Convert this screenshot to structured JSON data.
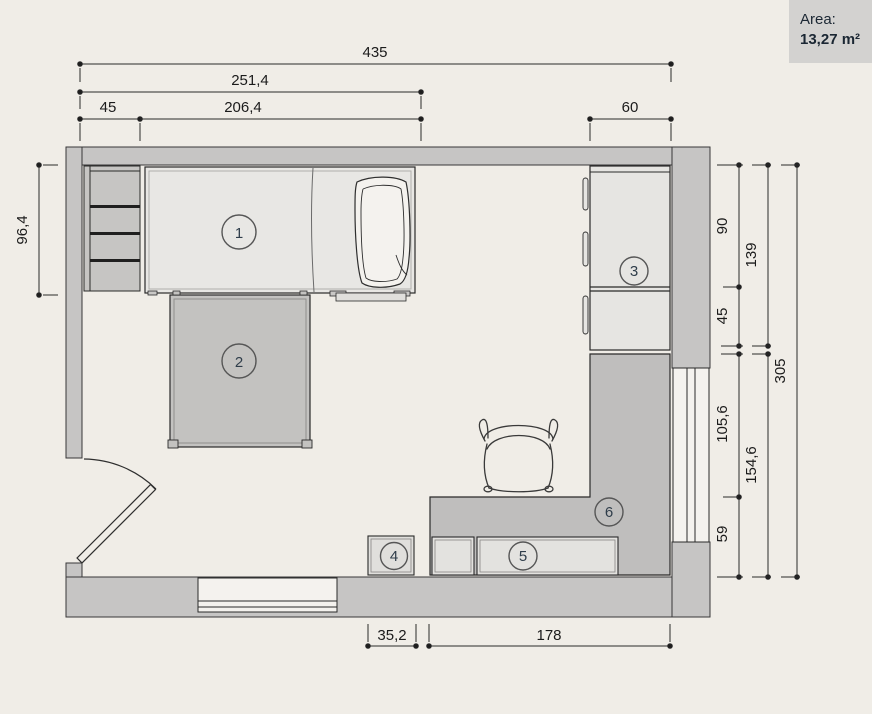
{
  "area_panel": {
    "label": "Area:",
    "value": "13,27 m²"
  },
  "floorplan": {
    "dims": {
      "top_total": "435",
      "top_left_group": "251,4",
      "top_shelf": "45",
      "top_bed": "206,4",
      "top_wardrobe": "60",
      "left_bed_depth": "96,4",
      "right_wardrobe_tall": "90",
      "right_wardrobe_total": "139",
      "right_wardrobe_base": "45",
      "right_desk_side": "105,6",
      "right_desk_zone": "154,6",
      "right_desk_front": "59",
      "right_room_depth": "305",
      "bottom_box": "35,2",
      "bottom_desk": "178"
    },
    "items": [
      {
        "number": "1",
        "name": "bed"
      },
      {
        "number": "2",
        "name": "table"
      },
      {
        "number": "3",
        "name": "wardrobe"
      },
      {
        "number": "4",
        "name": "box"
      },
      {
        "number": "5",
        "name": "low-cabinet"
      },
      {
        "number": "6",
        "name": "desk"
      }
    ]
  }
}
